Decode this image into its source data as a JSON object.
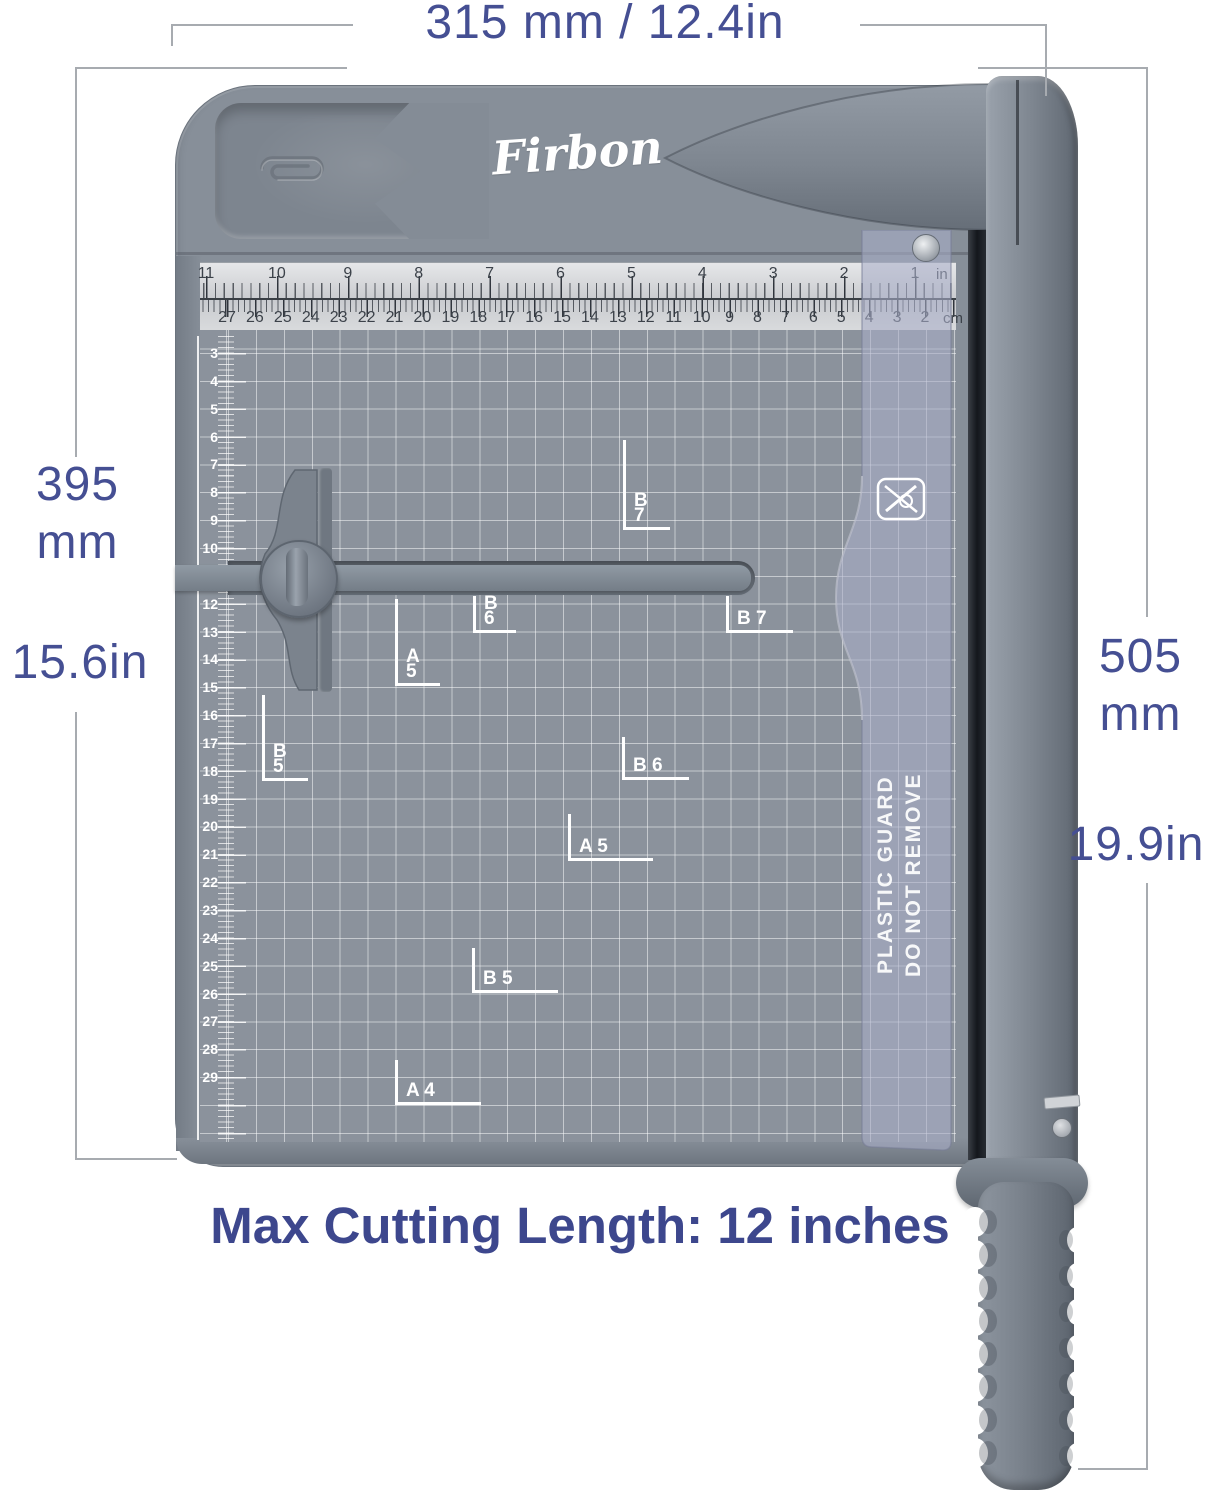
{
  "colors": {
    "accent_text": "#454F93",
    "caption_text": "#3D478D",
    "board_gray": "#878F99",
    "guard_lavender": "#A9AFC9",
    "ruler_bg": "#D8DADC",
    "grid_line": "#FFFFFF",
    "blade_slot": "#15181D"
  },
  "dimensions": {
    "top_width": "315 mm / 12.4in",
    "left_value": "395",
    "left_unit": "mm",
    "left_inches": "15.6in",
    "right_value": "505",
    "right_unit": "mm",
    "right_inches": "19.9in"
  },
  "caption": "Max Cutting Length: 12 inches",
  "product": {
    "brand": "Firbon",
    "top_ruler": {
      "inch_labels": [
        "11",
        "10",
        "9",
        "8",
        "7",
        "6",
        "5",
        "4",
        "3",
        "2",
        "1"
      ],
      "inch_unit": "in",
      "cm_labels": [
        "27",
        "26",
        "25",
        "24",
        "23",
        "22",
        "21",
        "20",
        "19",
        "18",
        "17",
        "16",
        "15",
        "14",
        "13",
        "12",
        "11",
        "10",
        "9",
        "8",
        "7",
        "6",
        "5",
        "4",
        "3",
        "2"
      ],
      "cm_unit": "cm"
    },
    "side_ruler_labels": [
      "3",
      "4",
      "5",
      "6",
      "7",
      "8",
      "9",
      "10",
      "12",
      "13",
      "14",
      "15",
      "16",
      "17",
      "18",
      "19",
      "20",
      "21",
      "22",
      "23",
      "24",
      "25",
      "26",
      "27",
      "28",
      "29"
    ],
    "size_marks": [
      {
        "l1": "B",
        "l2": "7"
      },
      {
        "l1": "B",
        "l2": "6"
      },
      {
        "l1": "A",
        "l2": "5"
      },
      {
        "l1": "B",
        "l2": "5"
      },
      {
        "l1": "B 7"
      },
      {
        "l1": "B 6"
      },
      {
        "l1": "A 5"
      },
      {
        "l1": "B 5"
      },
      {
        "l1": "A 4"
      }
    ],
    "guard_warning": {
      "line1": "DO NOT REMOVE",
      "line2": "PLASTIC GUARD"
    }
  }
}
